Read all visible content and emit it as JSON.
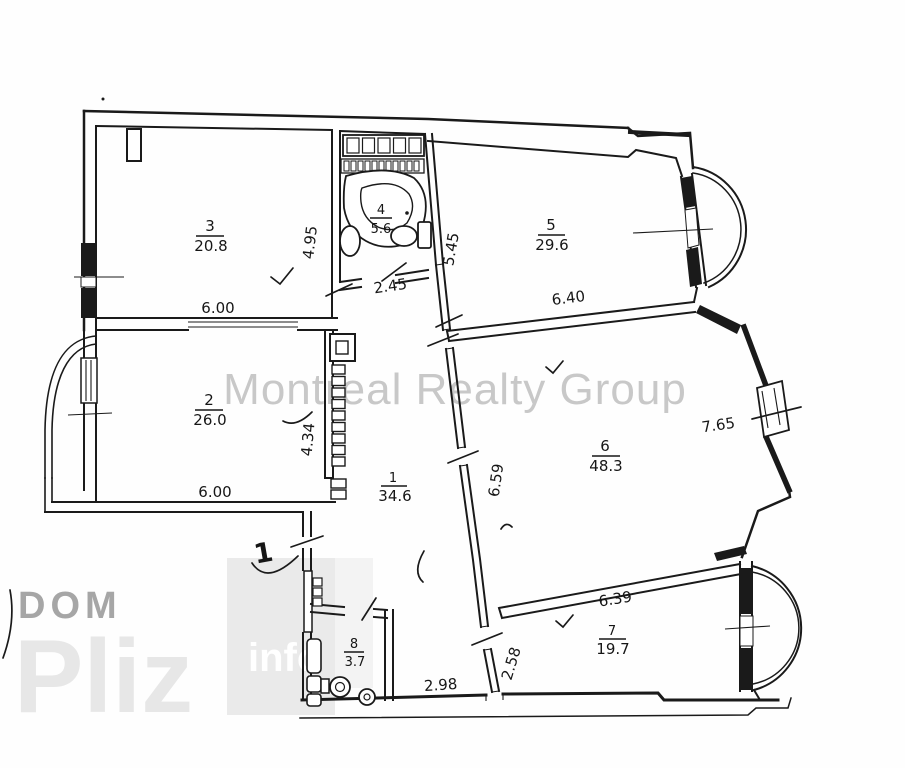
{
  "watermark": {
    "brand": "Montreal Realty Group",
    "logo_small": "DOM",
    "logo_large": "Pliz",
    "logo_accent": "info"
  },
  "plan": {
    "rooms": {
      "room1": {
        "number": "1",
        "area": "34.6"
      },
      "room2": {
        "number": "2",
        "area": "26.0"
      },
      "room3": {
        "number": "3",
        "area": "20.8"
      },
      "room4": {
        "number": "4",
        "area": "5.6"
      },
      "room5": {
        "number": "5",
        "area": "29.6"
      },
      "room6": {
        "number": "6",
        "area": "48.3"
      },
      "room7": {
        "number": "7",
        "area": "19.7"
      },
      "room8": {
        "number": "8",
        "area": "3.7"
      }
    },
    "dims": {
      "room3_w": "6.00",
      "room3_h": "4.95",
      "bath_w": "2.45",
      "room5_h": "5.45",
      "room5_w": "6.40",
      "room2_w": "6.00",
      "room2_h": "4.34",
      "room6_h": "6.59",
      "room6_w": "7.65",
      "room7_w": "6.39",
      "room7_h": "2.58",
      "hall_w": "2.98"
    },
    "annotations": {
      "handwritten_mark": "1"
    }
  },
  "colors": {
    "line": "#1a1a1a",
    "watermark_text": "#c8c8c8",
    "logo_gray": "#a6a6a6",
    "logo_light": "#e7e7e7",
    "logo_box": "#eaeaea",
    "logo_accent_text": "#ffffff",
    "background": "#ffffff"
  }
}
